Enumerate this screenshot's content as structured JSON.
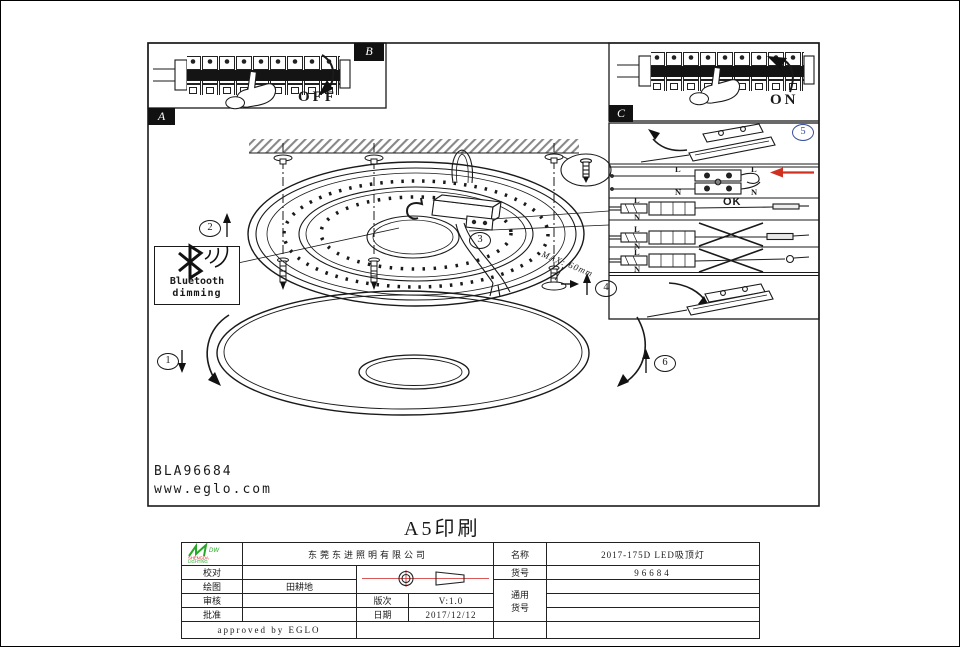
{
  "page": {
    "print_title": "A5印刷"
  },
  "panel_labels": {
    "a": "A",
    "b": "B",
    "c": "C"
  },
  "switch": {
    "off": "OFF",
    "on": "ON"
  },
  "steps": {
    "s1": "1",
    "s2": "2",
    "s3": "3",
    "s4": "4",
    "s5": "5",
    "s6": "6"
  },
  "wiring": {
    "l": "L",
    "n": "N",
    "ok": "OK"
  },
  "callout": {
    "bluetooth_line1": "Bluetooth",
    "bluetooth_line2": "dimming",
    "max_depth": "MAX: 60mm"
  },
  "footer": {
    "model_code": "BLA96684",
    "website": "www.eglo.com"
  },
  "title_block": {
    "company": "东莞东进照明有限公司",
    "logo": {
      "mark": "DW",
      "top": "SHENGDA",
      "bottom": "LIGHTING"
    },
    "labels": {
      "proofread": "校对",
      "drawing": "绘图",
      "review": "审核",
      "approve": "批准",
      "version": "版次",
      "date": "日期",
      "name": "名称",
      "item": "货号",
      "generic1": "通用",
      "generic2": "货号"
    },
    "values": {
      "drawing_by": "田耕地",
      "version": "V:1.0",
      "date": "2017/12/12",
      "product_name": "2017-175D LED吸顶灯",
      "item_no": "96684",
      "approved_note": "approved by EGLO"
    }
  }
}
